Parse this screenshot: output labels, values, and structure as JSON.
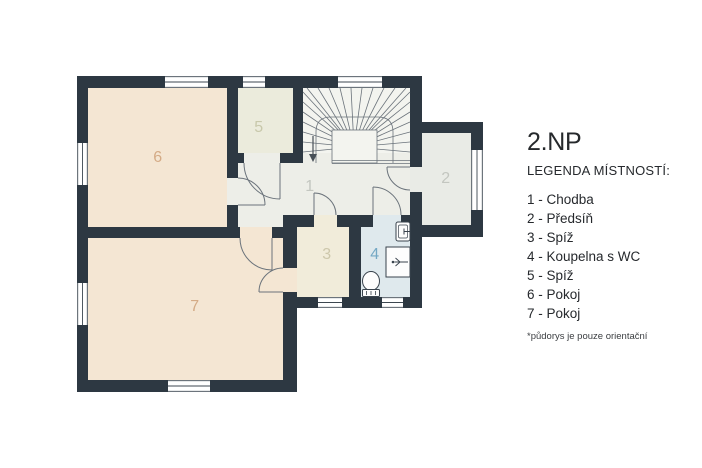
{
  "title": "2.NP",
  "legend": {
    "heading": "LEGENDA MÍSTNOSTÍ:",
    "items": [
      {
        "label": "1 - Chodba"
      },
      {
        "label": "2 - Předsíň"
      },
      {
        "label": "3 - Spíž"
      },
      {
        "label": "4 - Koupelna s WC"
      },
      {
        "label": "5 - Spíž"
      },
      {
        "label": "6 - Pokoj"
      },
      {
        "label": "7 - Pokoj"
      }
    ],
    "footnote": "*půdorys je pouze orientační"
  },
  "plan": {
    "rooms": {
      "r1": "1",
      "r2": "2",
      "r3": "3",
      "r4": "4",
      "r5": "5",
      "r6": "6",
      "r7": "7"
    }
  },
  "colors": {
    "wall": "#2d3842",
    "beige": "#f4e6d3",
    "sage": "#ebebdc",
    "cream": "#f1ecda",
    "hallfloor": "#edeee8",
    "stairfloor": "#f3f4ef",
    "grayfloor": "#e9ebe6",
    "bluefloor": "#dfe9ed",
    "line": "#6b737b",
    "fixture": "#39434d",
    "text": "#26292d",
    "label_tan": "#d4ab86",
    "label_sage": "#c8c8ab",
    "label_gray": "#c3c6c0",
    "label_cream": "#cdc7ab",
    "label_blue": "#74a8c4"
  }
}
